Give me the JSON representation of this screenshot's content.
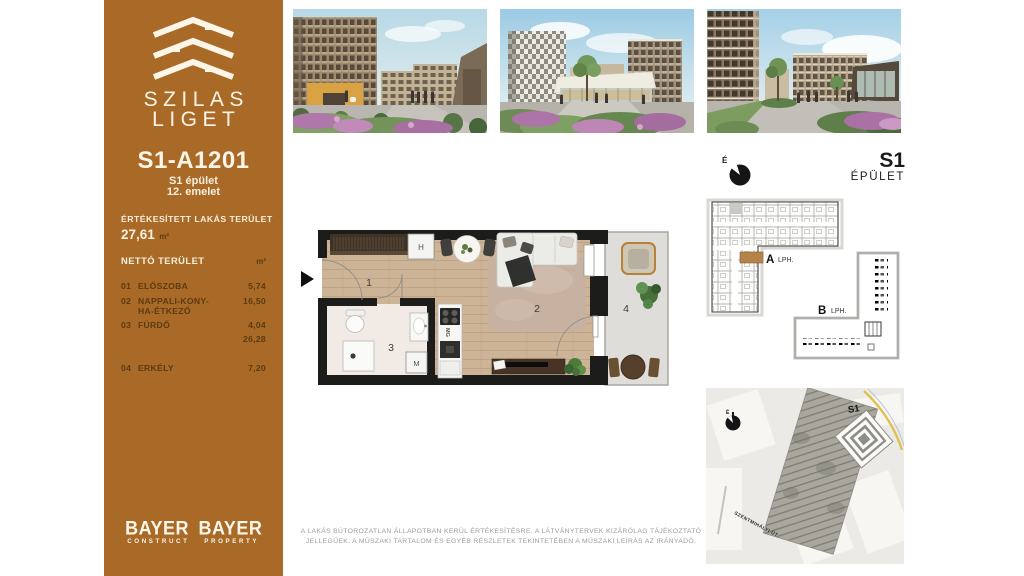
{
  "sidebar": {
    "brand_line1": "SZILAS",
    "brand_line2": "LIGET",
    "unit_id": "S1-A1201",
    "building": "S1 épület",
    "floor": "12. emelet",
    "sold_label": "ÉRTÉKESÍTETT LAKÁS TERÜLET",
    "sold_value": "27,61",
    "sold_unit": "m²",
    "net_label": "NETTÓ TERÜLET",
    "net_unit": "m²",
    "rooms": [
      {
        "num": "01",
        "name": "ELŐSZOBA",
        "area": "5,74"
      },
      {
        "num": "02",
        "name": "NAPPALI-KONY-\nHA-ÉTKEZŐ",
        "area": "16,50"
      },
      {
        "num": "03",
        "name": "FÜRDŐ",
        "area": "4,04"
      },
      {
        "num": "",
        "name": "",
        "area": "26,28"
      },
      {
        "num": "04",
        "name": "ERKÉLY",
        "area": "7,20"
      }
    ],
    "logo1_name": "BAYER",
    "logo1_sub": "CONSTRUCT",
    "logo2_name": "BAYER",
    "logo2_sub": "PROPERTY"
  },
  "plan": {
    "room1": "1",
    "room2": "2",
    "room3": "3",
    "room4": "4",
    "closet": "H",
    "washer": "M",
    "dishwasher": "MG"
  },
  "building_diagram": {
    "north": "É",
    "title": "S1",
    "subtitle": "ÉPÜLET",
    "core_a": "A",
    "core_a_sub": "LPH.",
    "core_b": "B",
    "core_b_sub": "LPH."
  },
  "site_map": {
    "north": "É",
    "building": "S1",
    "street": "SZENTMIHÁLYI ÚT"
  },
  "disclaimer_line1": "A LAKÁS BÚTOROZATLAN ÁLLAPOTBAN KERÜL ÉRTÉKESÍTÉSRE. A LÁTVÁNYTERVEK KIZÁRÓLAG TÁJÉKOZTATÓ",
  "disclaimer_line2": "JELLEGŰEK. A MŰSZAKI TARTALOM ÉS EGYÉB RÉSZLETEK TEKINTETÉBEN A MŰSZAKI LEÍRÁS AZ IRÁNYADÓ.",
  "colors": {
    "sidebar": "#a86a26",
    "text_cream": "#f6ecd9",
    "text_dark_brown": "#5c3a12",
    "unit_highlight": "#b5824a",
    "wall": "#1c1c1a"
  }
}
